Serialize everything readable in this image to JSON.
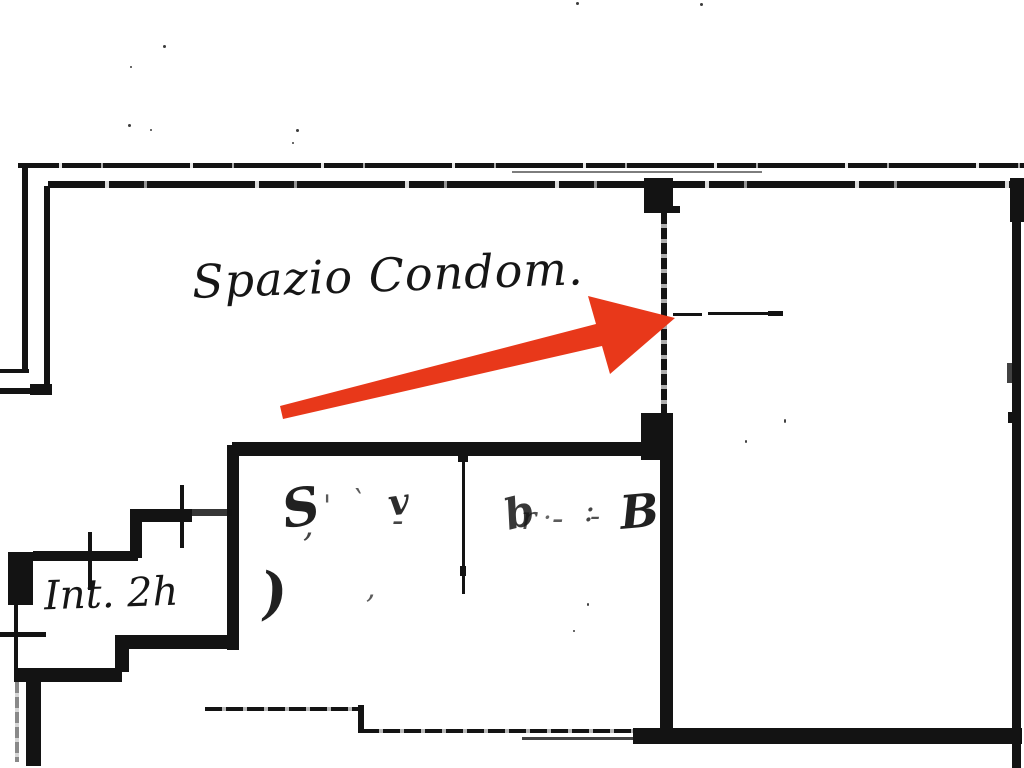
{
  "labels": {
    "spazio_condom": "Spazio Condom.",
    "int_2h": "Int. 2h"
  },
  "scrawls": {
    "room_left": [
      {
        "t": "S",
        "x": 278,
        "y": 486,
        "fs": 52,
        "o": 0.95,
        "r": -10,
        "b": 1
      },
      {
        "t": ",",
        "x": 303,
        "y": 508,
        "fs": 34,
        "o": 0.8
      },
      {
        "t": "'",
        "x": 323,
        "y": 492,
        "fs": 30,
        "o": 0.7
      },
      {
        "t": "`",
        "x": 350,
        "y": 488,
        "fs": 30,
        "o": 0.7
      },
      {
        "t": "v",
        "x": 386,
        "y": 486,
        "fs": 36,
        "o": 0.9,
        "r": -8,
        "b": 1
      },
      {
        "t": "-",
        "x": 392,
        "y": 504,
        "fs": 34,
        "o": 0.8
      },
      {
        "t": ")",
        "x": 258,
        "y": 566,
        "fs": 56,
        "o": 0.95,
        "r": -6,
        "b": 1
      },
      {
        "t": ",",
        "x": 366,
        "y": 574,
        "fs": 30,
        "o": 0.7
      }
    ],
    "room_right": [
      {
        "t": "b",
        "x": 500,
        "y": 496,
        "fs": 42,
        "o": 0.85,
        "r": -14,
        "b": 1
      },
      {
        "t": "r",
        "x": 521,
        "y": 502,
        "fs": 32,
        "o": 0.75
      },
      {
        "t": "·",
        "x": 543,
        "y": 504,
        "fs": 28,
        "o": 0.65
      },
      {
        "t": "-",
        "x": 552,
        "y": 502,
        "fs": 34,
        "o": 0.7
      },
      {
        "t": ":",
        "x": 584,
        "y": 494,
        "fs": 32,
        "o": 0.8
      },
      {
        "t": "-",
        "x": 590,
        "y": 502,
        "fs": 30,
        "o": 0.75
      },
      {
        "t": "B",
        "x": 618,
        "y": 490,
        "fs": 46,
        "o": 0.95,
        "r": -5,
        "b": 1
      }
    ]
  },
  "colors": {
    "arrow": "#e8381a",
    "ink": "#131313",
    "paper": "#ffffff"
  }
}
